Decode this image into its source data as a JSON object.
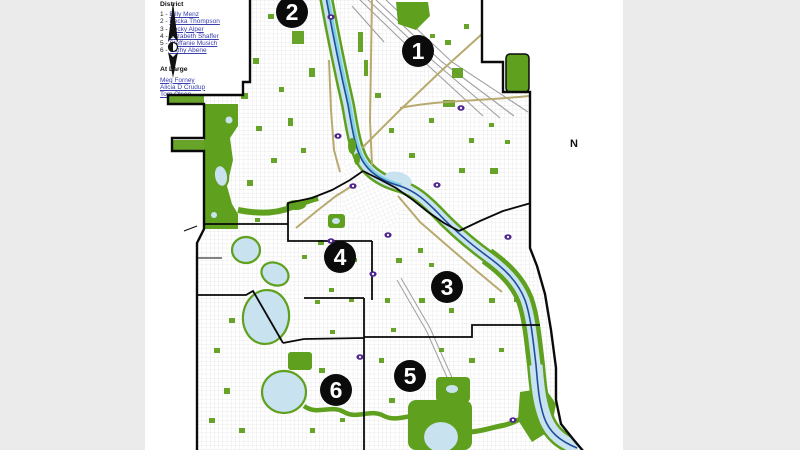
{
  "window": {
    "bg_color": "#ebebeb",
    "content_bg": "#ffffff"
  },
  "legend": {
    "district_heading": "District",
    "separator": " - ",
    "district_members": [
      {
        "num": "1",
        "name": "Billy Menz"
      },
      {
        "num": "2",
        "name": "Becka Thompson"
      },
      {
        "num": "3",
        "name": "Becky Alper"
      },
      {
        "num": "4",
        "name": "Elizabeth Shaffer"
      },
      {
        "num": "5",
        "name": "Steffanie Musich"
      },
      {
        "num": "6",
        "name": "Cathy Abene"
      }
    ],
    "at_large_heading": "At Large",
    "at_large_members": [
      "Meg Forney",
      "Alicia D Crudup",
      "Tom Olsen"
    ],
    "link_color": "#3a3fae"
  },
  "map": {
    "description": "Minneapolis park district map with numbered district markers",
    "district_labels": [
      {
        "num": "1",
        "x": 418,
        "y": 51
      },
      {
        "num": "2",
        "x": 292,
        "y": 12
      },
      {
        "num": "3",
        "x": 447,
        "y": 287
      },
      {
        "num": "4",
        "x": 340,
        "y": 257
      },
      {
        "num": "5",
        "x": 410,
        "y": 376
      },
      {
        "num": "6",
        "x": 336,
        "y": 390
      }
    ],
    "north_label": "N",
    "colors": {
      "park": "#5fa01e",
      "water": "#c9e2f0",
      "river": "#1e4d9b",
      "river_glow": "#7fd0e2",
      "boundary": "#0a0a0a",
      "street": "#c8c8c8",
      "rail": "#9f9f9f",
      "road": "#b8aa6e",
      "shield": "#50288e"
    }
  }
}
